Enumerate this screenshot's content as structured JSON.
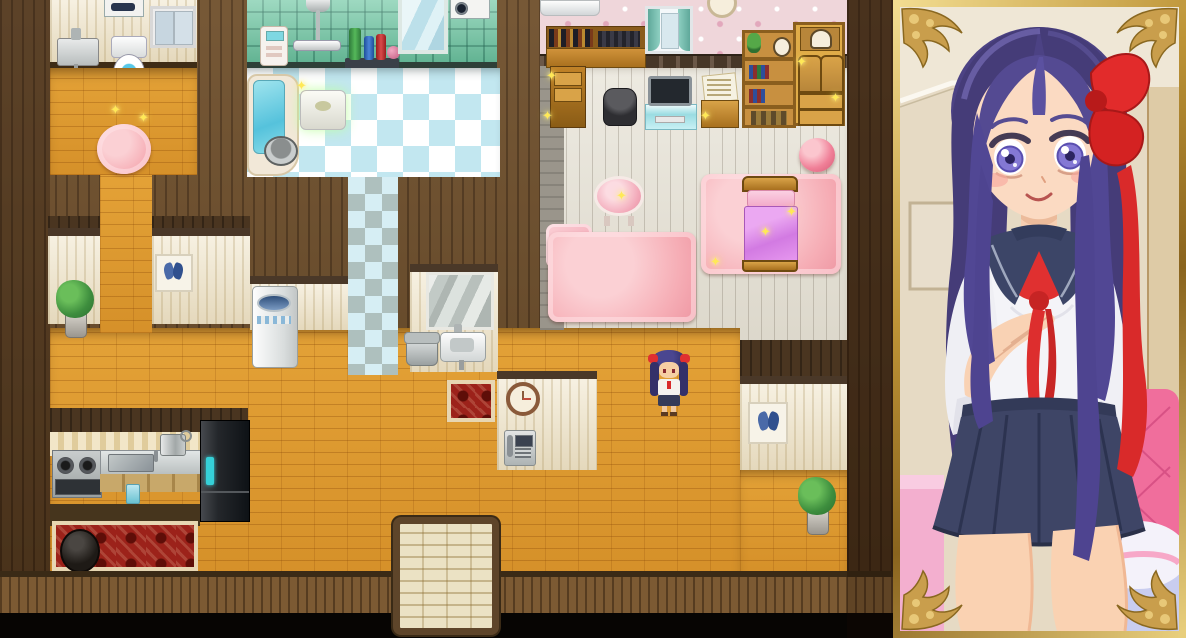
{
  "meta": {
    "app_label": "RPG-style house interior with character portrait",
    "view_label": "Top-down home map, player character in hallway, girl portrait in gold frame"
  },
  "map": {
    "label": "house map viewport",
    "rooms": [
      {
        "id": "toilet-room",
        "label": "Toilet room"
      },
      {
        "id": "bathroom",
        "label": "Bathroom"
      },
      {
        "id": "bedroom",
        "label": "Bedroom"
      },
      {
        "id": "kitchen",
        "label": "Kitchen"
      },
      {
        "id": "hallway",
        "label": "Hallway"
      },
      {
        "id": "entrance",
        "label": "Entrance"
      }
    ],
    "furniture": [
      "washing machine",
      "window",
      "wall sink",
      "toilet",
      "pink fluffy rug",
      "shower",
      "bath control panel",
      "shampoo shelf",
      "bath mirror",
      "drum washer",
      "bathtub",
      "bath stool",
      "bucket",
      "air conditioner",
      "desk with books",
      "curtained window",
      "wall clock",
      "trash bin",
      "tv on stand",
      "paper cabinet",
      "bookshelf",
      "wooden dresser",
      "pink ball",
      "vanity table",
      "love pillow",
      "large pink rug",
      "bed rug",
      "bed",
      "butterfly picture",
      "potted plant",
      "laundry washing machine",
      "wash mirror",
      "laundry tub",
      "hand sink",
      "small red rug",
      "hall clock",
      "wall phone",
      "stove",
      "kitchen counter sink",
      "cooking pot",
      "refrigerator",
      "red carpet",
      "iron pot",
      "entrance mat"
    ],
    "character": {
      "label": "player character",
      "description": "small girl sprite, dark purple hair with two red bows, white blouse, navy skirt"
    }
  },
  "pillow": {
    "text": "Love"
  },
  "portrait": {
    "label": "character portrait",
    "description": "girl with long purple hair, large red hair bow, sailor school uniform with red neckerchief, navy pleated skirt, hand on chest",
    "frame_style": "ornate gold frame with floral corners"
  },
  "colors": {
    "floor_orange": "#E09A2E",
    "wall_brown": "#6E4E2A",
    "wall_cream": "#F2E9D2",
    "bath_tile_green": "#74C9A6",
    "wallpaper_pink": "#EFD6DA",
    "rug_pink": "#F6AEB6",
    "rug_red": "#9C221A",
    "frame_gold": "#C79C44",
    "hair_purple": "#4C4284",
    "bow_red": "#E22B2B",
    "uniform_navy": "#3C4567",
    "sparkle_yellow": "#FFE957"
  }
}
